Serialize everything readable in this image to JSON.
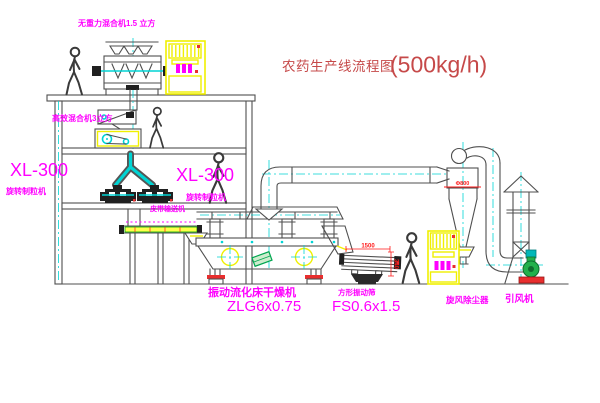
{
  "title": {
    "text": "农药生产线流程图",
    "capacity": "(500kg/h)"
  },
  "labels": {
    "gravity_free_mixer": "无重力混合机1.5 立方",
    "high_efficiency_mixer": "高效混合机3立方",
    "granulator_left_model": "XL-300",
    "granulator_left_name": "旋转制粒机",
    "granulator_right_model": "XL-300",
    "granulator_right_name": "旋转制粒机",
    "belt_conveyor": "皮带输送机",
    "dryer_name": "振动流化床干燥机",
    "dryer_model": "ZLG6x0.75",
    "sieve_name": "方形振动筛",
    "sieve_model": "FS0.6x1.5",
    "cyclone_name": "旋风除尘器",
    "fan_name": "引风机"
  },
  "dimensions": {
    "cyclone_diameter": "Φ800",
    "sieve_length": "1500",
    "sieve_height": "340"
  },
  "colors": {
    "label_magenta": "#ff00ff",
    "title_red": "#c64949",
    "dimension_red": "#ff1a1a",
    "centerline_cyan": "#00d4d4",
    "highlight_yellow": "#f0f000",
    "accent_green": "#22b14c",
    "base_red": "#e82e2e",
    "line_gray": "#4f4f4f"
  }
}
